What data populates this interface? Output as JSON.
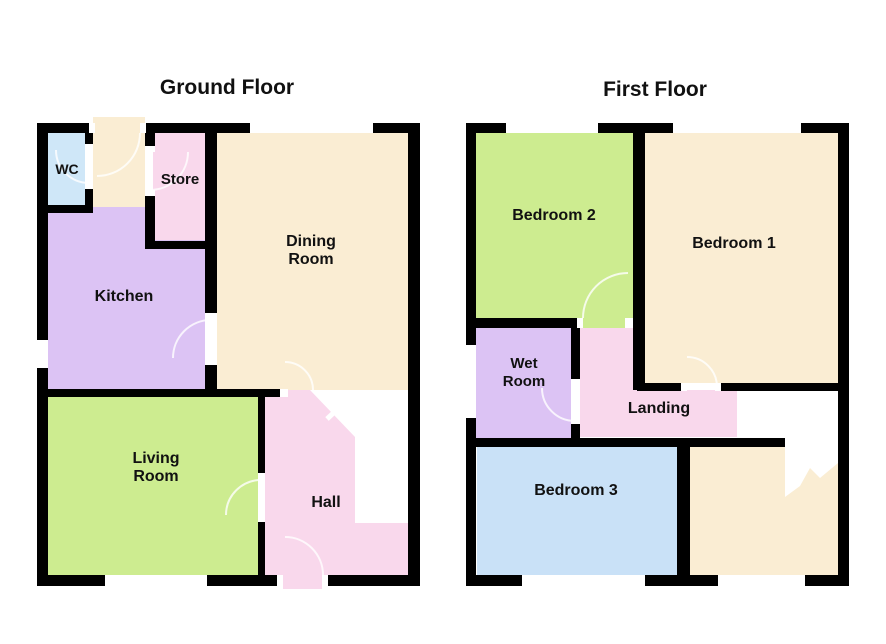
{
  "image": {
    "width": 886,
    "height": 644,
    "background": "#ffffff"
  },
  "style": {
    "wall_color": "#000000",
    "void_color": "#ffffff",
    "jamb_color": "#ffffff",
    "arc_color": "#ffffff",
    "text_color": "#111111"
  },
  "palette": {
    "cream": "#FAEDD3",
    "green": "#CDEC90",
    "purple": "#DCC3F4",
    "pink": "#F9D8EC",
    "blue_light": "#CFE7F8",
    "blue": "#C9E1F7"
  },
  "floors": [
    {
      "id": "ground-floor",
      "title": {
        "text": "Ground Floor",
        "x": 227,
        "y": 94,
        "size": 21
      },
      "rooms": [
        {
          "name": "entrance-porch",
          "color": "cream",
          "rect": [
            93,
            117,
            52,
            90
          ]
        },
        {
          "name": "wc",
          "color": "blue_light",
          "rect": [
            48,
            133,
            37,
            72
          ]
        },
        {
          "name": "kitchen",
          "color": "purple",
          "rect": [
            48,
            207,
            157,
            183
          ]
        },
        {
          "name": "store",
          "color": "pink",
          "rect": [
            153,
            133,
            52,
            107
          ]
        },
        {
          "name": "dining-room",
          "color": "cream",
          "rect": [
            217,
            133,
            191,
            257
          ]
        },
        {
          "name": "living-room",
          "color": "green",
          "rect": [
            48,
            397,
            210,
            178
          ]
        },
        {
          "name": "hall",
          "color": "pink",
          "rect": [
            265,
            390,
            143,
            185
          ]
        },
        {
          "name": "hall-door-threshold",
          "color": "pink",
          "rect": [
            283,
            575,
            39,
            14
          ]
        }
      ],
      "voids": [
        {
          "name": "stair-void",
          "points": [
            [
              310,
              390
            ],
            [
              408,
              390
            ],
            [
              408,
              523
            ],
            [
              355,
              523
            ],
            [
              355,
              437
            ]
          ]
        }
      ],
      "walls": [
        [
          37,
          123,
          58,
          10
        ],
        [
          140,
          123,
          110,
          10
        ],
        [
          373,
          123,
          47,
          10
        ],
        [
          37,
          123,
          11,
          217
        ],
        [
          37,
          368,
          11,
          218
        ],
        [
          408,
          123,
          12,
          463
        ],
        [
          37,
          575,
          68,
          11
        ],
        [
          207,
          575,
          76,
          11
        ],
        [
          322,
          575,
          98,
          11
        ],
        [
          85,
          133,
          8,
          17
        ],
        [
          85,
          183,
          8,
          22
        ],
        [
          48,
          205,
          45,
          8
        ],
        [
          145,
          123,
          10,
          29
        ],
        [
          145,
          190,
          10,
          59
        ],
        [
          145,
          241,
          62,
          8
        ],
        [
          205,
          123,
          12,
          197
        ],
        [
          205,
          358,
          12,
          39
        ],
        [
          48,
          389,
          232,
          8
        ],
        [
          258,
          397,
          7,
          83
        ],
        [
          258,
          515,
          7,
          60
        ]
      ],
      "jambs": [
        [
          89,
          123,
          6,
          10
        ],
        [
          140,
          123,
          6,
          10
        ],
        [
          85,
          144,
          8,
          6
        ],
        [
          85,
          183,
          8,
          6
        ],
        [
          145,
          146,
          10,
          6
        ],
        [
          145,
          190,
          10,
          6
        ],
        [
          205,
          313,
          12,
          7
        ],
        [
          205,
          358,
          12,
          7
        ],
        [
          258,
          473,
          7,
          7
        ],
        [
          258,
          515,
          7,
          7
        ],
        [
          280,
          389,
          8,
          8
        ],
        [
          277,
          575,
          6,
          11
        ],
        [
          322,
          575,
          6,
          11
        ]
      ],
      "arcs": [
        "M 140,133 A 43 43 0 0 1 97,176",
        "M 89,183 A 33 33 0 0 1 56,150",
        "M 150,190 A 38 38 0 0 0 188,152",
        "M 211,320 A 38 38 0 0 0 173,358",
        "M 261,480 A 35 35 0 0 0 226,515",
        "M 313,390 A 28 28 0 0 0 285,362",
        "M 285,537 A 38 38 0 0 1 323,575"
      ],
      "ticks": [
        [
          327,
          419,
          344,
          403
        ]
      ],
      "labels": [
        {
          "lines": [
            "WC"
          ],
          "x": 67,
          "y": 174,
          "size": 14,
          "lh": 17
        },
        {
          "lines": [
            "Store"
          ],
          "x": 180,
          "y": 184,
          "size": 15,
          "lh": 17
        },
        {
          "lines": [
            "Dining",
            "Room"
          ],
          "x": 311,
          "y": 246,
          "size": 16,
          "lh": 18
        },
        {
          "lines": [
            "Kitchen"
          ],
          "x": 124,
          "y": 301,
          "size": 16,
          "lh": 18
        },
        {
          "lines": [
            "Living",
            "Room"
          ],
          "x": 156,
          "y": 463,
          "size": 16,
          "lh": 18
        },
        {
          "lines": [
            "Hall"
          ],
          "x": 326,
          "y": 507,
          "size": 16,
          "lh": 18
        }
      ]
    },
    {
      "id": "first-floor",
      "title": {
        "text": "First Floor",
        "x": 655,
        "y": 96,
        "size": 21
      },
      "rooms": [
        {
          "name": "bedroom-2",
          "color": "green",
          "rect": [
            476,
            133,
            157,
            185
          ]
        },
        {
          "name": "bedroom-2-door-threshold",
          "color": "green",
          "rect": [
            583,
            318,
            42,
            10
          ]
        },
        {
          "name": "bedroom-1",
          "color": "cream",
          "rect": [
            645,
            133,
            193,
            250
          ]
        },
        {
          "name": "wet-room",
          "color": "purple",
          "rect": [
            476,
            327,
            95,
            111
          ]
        },
        {
          "name": "landing",
          "color": "pink",
          "points": [
            [
              580,
              328
            ],
            [
              633,
              328
            ],
            [
              633,
              390
            ],
            [
              737,
              390
            ],
            [
              737,
              437
            ],
            [
              580,
              437
            ]
          ]
        },
        {
          "name": "bedroom-3",
          "color": "blue",
          "rect": [
            477,
            447,
            200,
            128
          ]
        },
        {
          "name": "stairwell-area",
          "color": "cream",
          "rect": [
            690,
            447,
            148,
            128
          ]
        }
      ],
      "voids": [
        {
          "name": "stair-void",
          "points": [
            [
              737,
              390
            ],
            [
              838,
              390
            ],
            [
              838,
              463
            ],
            [
              820,
              478
            ],
            [
              810,
              468
            ],
            [
              800,
              486
            ],
            [
              785,
              497
            ],
            [
              785,
              438
            ],
            [
              737,
              438
            ]
          ]
        }
      ],
      "walls": [
        [
          466,
          123,
          40,
          10
        ],
        [
          598,
          123,
          75,
          10
        ],
        [
          801,
          123,
          48,
          10
        ],
        [
          466,
          123,
          10,
          222
        ],
        [
          466,
          418,
          10,
          168
        ],
        [
          838,
          123,
          11,
          463
        ],
        [
          466,
          575,
          56,
          11
        ],
        [
          645,
          575,
          73,
          11
        ],
        [
          805,
          575,
          44,
          11
        ],
        [
          633,
          123,
          12,
          267
        ],
        [
          466,
          318,
          112,
          10
        ],
        [
          637,
          383,
          50,
          8
        ],
        [
          715,
          383,
          134,
          8
        ],
        [
          571,
          328,
          9,
          57
        ],
        [
          571,
          418,
          9,
          20
        ],
        [
          466,
          438,
          319,
          9
        ],
        [
          677,
          447,
          13,
          128
        ]
      ],
      "jambs": [
        [
          577,
          318,
          6,
          10
        ],
        [
          625,
          318,
          7,
          10
        ],
        [
          681,
          383,
          6,
          8
        ],
        [
          715,
          383,
          6,
          8
        ],
        [
          571,
          379,
          9,
          6
        ],
        [
          571,
          418,
          9,
          6
        ]
      ],
      "arcs": [
        "M 583,318 A 45 45 0 0 1 628,273",
        "M 687,357 A 30 30 0 0 1 717,387",
        "M 542,388 A 33 33 0 0 0 575,421"
      ],
      "ticks": [],
      "labels": [
        {
          "lines": [
            "Bedroom 2"
          ],
          "x": 554,
          "y": 220,
          "size": 16,
          "lh": 18
        },
        {
          "lines": [
            "Bedroom 1"
          ],
          "x": 734,
          "y": 248,
          "size": 16,
          "lh": 18
        },
        {
          "lines": [
            "Wet",
            "Room"
          ],
          "x": 524,
          "y": 368,
          "size": 15,
          "lh": 18
        },
        {
          "lines": [
            "Landing"
          ],
          "x": 659,
          "y": 413,
          "size": 16,
          "lh": 18
        },
        {
          "lines": [
            "Bedroom 3"
          ],
          "x": 576,
          "y": 495,
          "size": 16,
          "lh": 18
        }
      ]
    }
  ]
}
